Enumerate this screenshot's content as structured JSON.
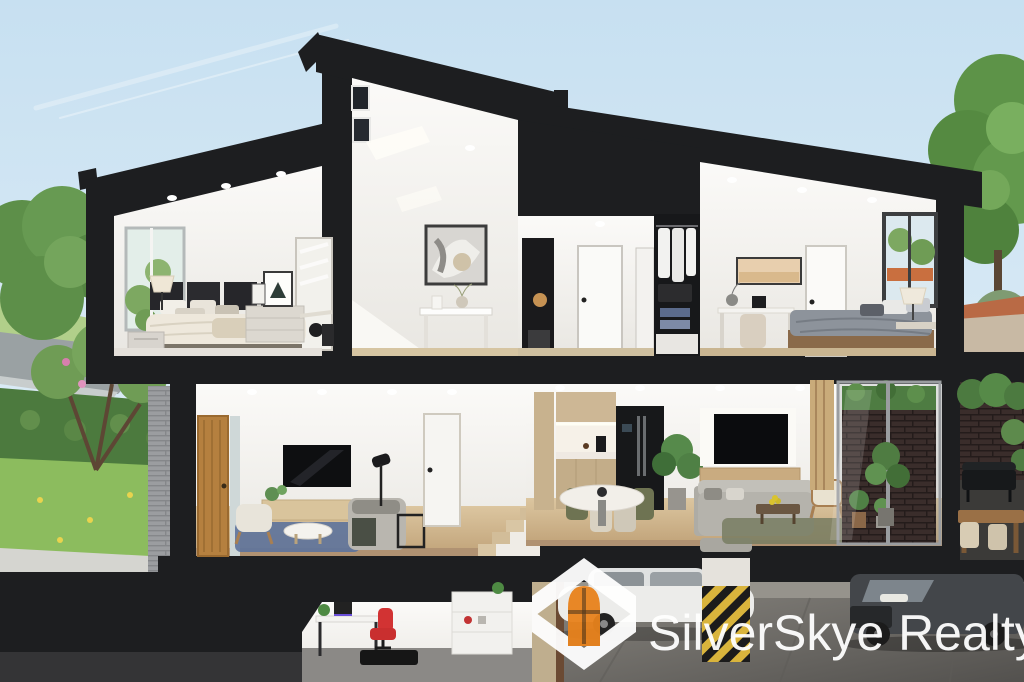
{
  "watermark": {
    "brand": "SilverSkye Realty",
    "logo_icon": "hexagon-s-door-icon",
    "text_color": "#ffffff",
    "mark_color": "#ffffff",
    "accent_orange": "#e8821c"
  },
  "palette": {
    "structure_black": "#1d1e20",
    "sky_top": "#c7e0f1",
    "sky_bottom": "#eef6fa",
    "foliage_green": "#5d9348",
    "hedge_green": "#4c7a3e",
    "lawn_green": "#8cbc5e",
    "blossom_pink": "#d77fae",
    "wood_floor": "#d2b58f",
    "concrete_grey": "#7b7975",
    "hazard_yellow": "#d9b43c",
    "brick_dark": "#3a2d2b",
    "brick_grey": "#9b9da0",
    "rug_blue": "#5d739c",
    "rug_green": "#787d62"
  },
  "scene": {
    "type": "residential-cutaway-3d-render",
    "levels": [
      {
        "name": "upper-floor",
        "rooms": [
          "bedroom-left",
          "stair-void-landing",
          "hallway",
          "walk-in-closet",
          "bedroom-right"
        ]
      },
      {
        "name": "ground-floor",
        "rooms": [
          "entry-living-room",
          "kitchen-dining",
          "family-room",
          "patio-outdoor-dining"
        ]
      },
      {
        "name": "basement",
        "rooms": [
          "home-office",
          "double-garage"
        ]
      }
    ],
    "exterior": [
      "front-garden-trees",
      "street",
      "lawn",
      "rear-courtyard-trees"
    ],
    "vehicles": [
      "white-sedan",
      "dark-suv"
    ],
    "hazard_column": true
  }
}
